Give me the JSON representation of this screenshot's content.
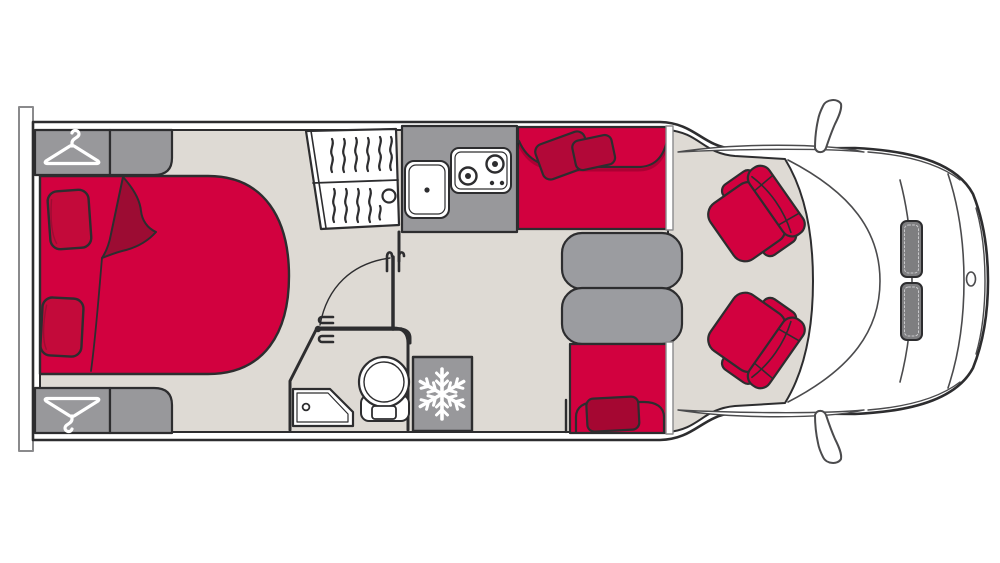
{
  "meta": {
    "title": "Motorhome floor plan - top view",
    "type": "vehicle-floor-plan",
    "visible_text": "none"
  },
  "colors": {
    "red": "#d2013f",
    "maroon": "#9c0c33",
    "pillow": "#c30a3a",
    "pillow_dark": "#b20838",
    "pillow_rear": "#a50732",
    "gray": "#98989b",
    "tablegray": "#9b9ca0",
    "floor": "#dedad4",
    "line": "#2d2d2f",
    "thinline": "#4b4b4d",
    "wallgray": "#8a8a8c",
    "headlight": "#7e7e80",
    "white": "#ffffff"
  },
  "icons": [
    {
      "name": "hanger-icon",
      "meaning": "wardrobe with clothes hanger",
      "count": 2
    },
    {
      "name": "snowflake-icon",
      "meaning": "refrigerator / freezer",
      "count": 1
    }
  ],
  "furniture": [
    {
      "name": "rear-wall-panel",
      "area": "rear"
    },
    {
      "name": "wardrobe-top",
      "area": "bedroom"
    },
    {
      "name": "wardrobe-bottom",
      "area": "bedroom"
    },
    {
      "name": "bed",
      "area": "bedroom",
      "pillows": 2,
      "blanket_fold": true
    },
    {
      "name": "hanging-closet",
      "area": "mid",
      "sections": 2
    },
    {
      "name": "kitchen-counter",
      "area": "kitchen",
      "items": [
        "sink",
        "hob-2-burner"
      ]
    },
    {
      "name": "bathroom",
      "area": "mid",
      "items": [
        "shower-tray",
        "toilet",
        "folding-door",
        "door-swing-arc"
      ]
    },
    {
      "name": "fridge",
      "area": "mid"
    },
    {
      "name": "dinette-bench-front",
      "area": "dinette",
      "pillows": 2
    },
    {
      "name": "dinette-table",
      "area": "dinette",
      "halves": 2
    },
    {
      "name": "dinette-bench-rear",
      "area": "dinette",
      "pillows": 1
    },
    {
      "name": "cab-seat-top",
      "area": "cab",
      "swivel": true
    },
    {
      "name": "cab-seat-bottom",
      "area": "cab",
      "swivel": true
    },
    {
      "name": "headlights",
      "area": "cab",
      "count": 2
    },
    {
      "name": "side-mirrors",
      "area": "cab",
      "count": 2
    },
    {
      "name": "brand-emblem",
      "area": "cab"
    }
  ]
}
